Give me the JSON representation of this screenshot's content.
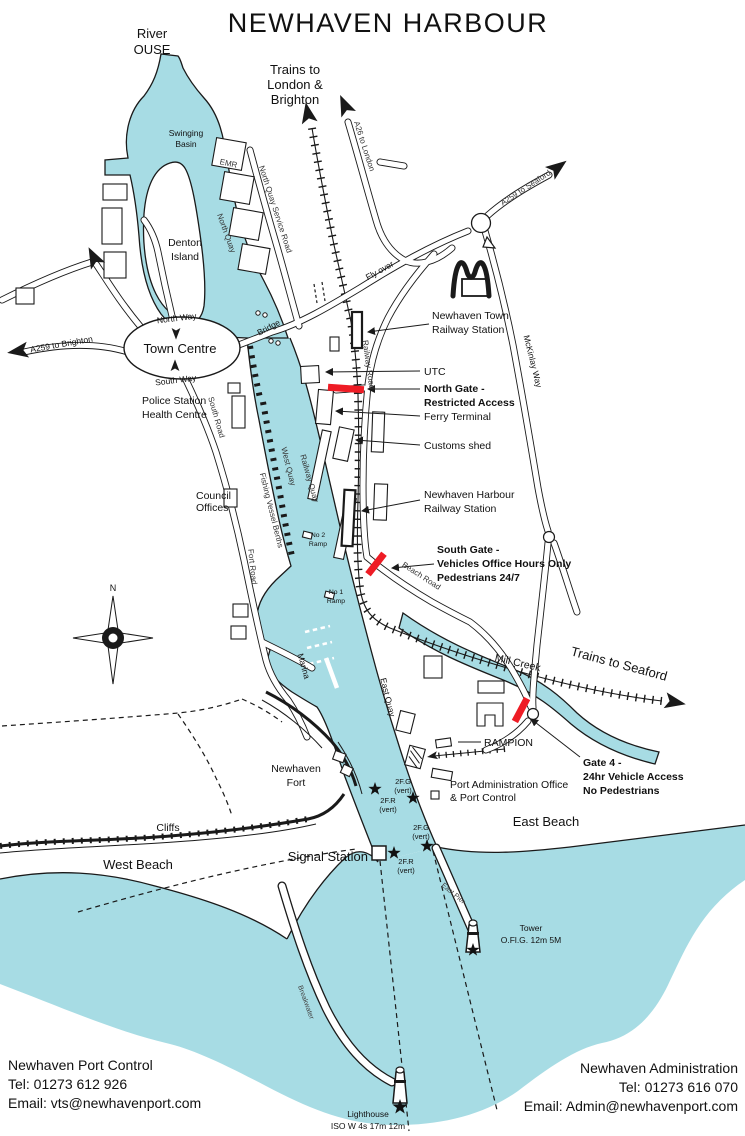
{
  "colors": {
    "water": "#a7dce4",
    "outline": "#1a1a1a",
    "gate_marker": "#ee1c25"
  },
  "title": "NEWHAVEN HARBOUR",
  "compass_north": "N",
  "water": {
    "river": [
      "River",
      "OUSE"
    ],
    "swinging_basin": [
      "Swinging",
      "Basin"
    ],
    "mill_creek": "Mill Creek"
  },
  "areas": {
    "denton_island": [
      "Denton",
      "Island"
    ],
    "town_centre": "Town Centre",
    "newhaven_fort": [
      "Newhaven",
      "Fort"
    ],
    "cliffs": "Cliffs",
    "west_beach": "West Beach",
    "east_beach": "East Beach",
    "marina": "Marina"
  },
  "roads": {
    "north_way": "North Way",
    "south_way": "South Way",
    "south_road": "South Road",
    "fort_road": "Fort Road",
    "bridge": "Bridge",
    "fly_over": "Fly over",
    "railway_road": "Railway Road",
    "beach_road": "Beach Road",
    "mckinlay_way": "McKinlay Way",
    "north_quay_service_road": "North Quay Service Road",
    "a26_to_london": "A26 to London",
    "a259_to_seaford": "A259 to Seaford",
    "a259_to_brighton": "A259 to Brighton"
  },
  "quays": {
    "north_quay": "North Quay",
    "west_quay": "West Quay",
    "railway_quay": "Railway Quay",
    "east_quay": "East Quay",
    "fishing_vessel_berths": "Fishing Vessel Berths",
    "no1_ramp": [
      "No 1",
      "Ramp"
    ],
    "no2_ramp": [
      "No 2",
      "Ramp"
    ]
  },
  "rail": {
    "trains_to_london": [
      "Trains to",
      "London &",
      "Brighton"
    ],
    "trains_to_seaford": "Trains to Seaford"
  },
  "places": {
    "emr": "EMR",
    "utc": "UTC",
    "ferry_terminal": "Ferry Terminal",
    "customs_shed": "Customs shed",
    "town_station": [
      "Newhaven Town",
      "Railway Station"
    ],
    "harbour_station": [
      "Newhaven Harbour",
      "Railway Station"
    ],
    "police_health": [
      "Police Station",
      "Health Centre"
    ],
    "council_offices": [
      "Council",
      "Offices"
    ],
    "rampion": "RAMPION",
    "port_admin": [
      "Port Administration Office",
      "& Port Control"
    ],
    "signal_station": "Signal Station"
  },
  "gates": {
    "north_gate": [
      "North Gate -",
      "Restricted Access"
    ],
    "south_gate": [
      "South Gate -",
      "Vehicles Office Hours Only",
      "Pedestrians 24/7"
    ],
    "gate_4": [
      "Gate 4 -",
      "24hr Vehicle Access",
      "No Pedestrians"
    ]
  },
  "navigation": {
    "lights": [
      {
        "code": "2F.G",
        "note": "(vert)"
      },
      {
        "code": "2F.R",
        "note": "(vert)"
      },
      {
        "code": "2F.G",
        "note": "(vert)"
      },
      {
        "code": "2F.R",
        "note": "(vert)"
      }
    ],
    "tower": [
      "Tower",
      "O.Fl.G. 12m 5M"
    ],
    "lighthouse": [
      "Lighthouse",
      "ISO W 4s 17m 12m"
    ],
    "east_pier": "East Pier",
    "breakwater": "Breakwater"
  },
  "contacts": {
    "port_control": {
      "name": "Newhaven Port Control",
      "tel": "Tel: 01273 612 926",
      "email": "Email: vts@newhavenport.com"
    },
    "administration": {
      "name": "Newhaven Administration",
      "tel": "Tel: 01273 616 070",
      "email": "Email: Admin@newhavenport.com"
    }
  }
}
